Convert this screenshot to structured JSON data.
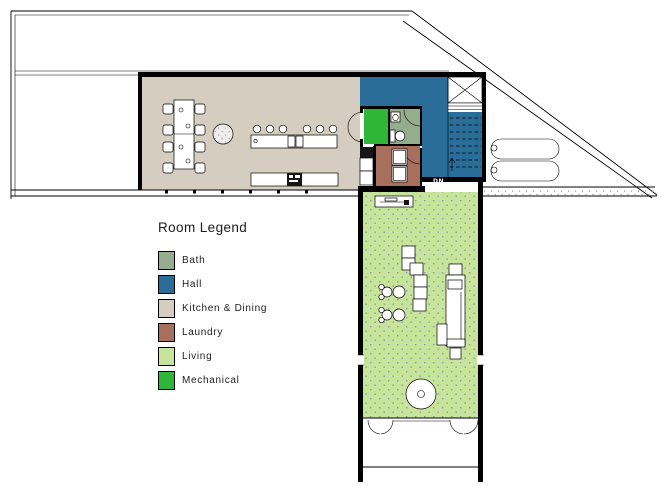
{
  "legend": {
    "title": "Room Legend",
    "items": [
      {
        "label": "Bath",
        "color": "#94AE8D"
      },
      {
        "label": "Hall",
        "color": "#2A6D99"
      },
      {
        "label": "Kitchen & Dining",
        "color": "#D5CEC0"
      },
      {
        "label": "Laundry",
        "color": "#A8705C"
      },
      {
        "label": "Living",
        "color": "#C7E49B"
      },
      {
        "label": "Mechanical",
        "color": "#2FB537"
      }
    ]
  },
  "plan": {
    "stair_label": "DN"
  }
}
